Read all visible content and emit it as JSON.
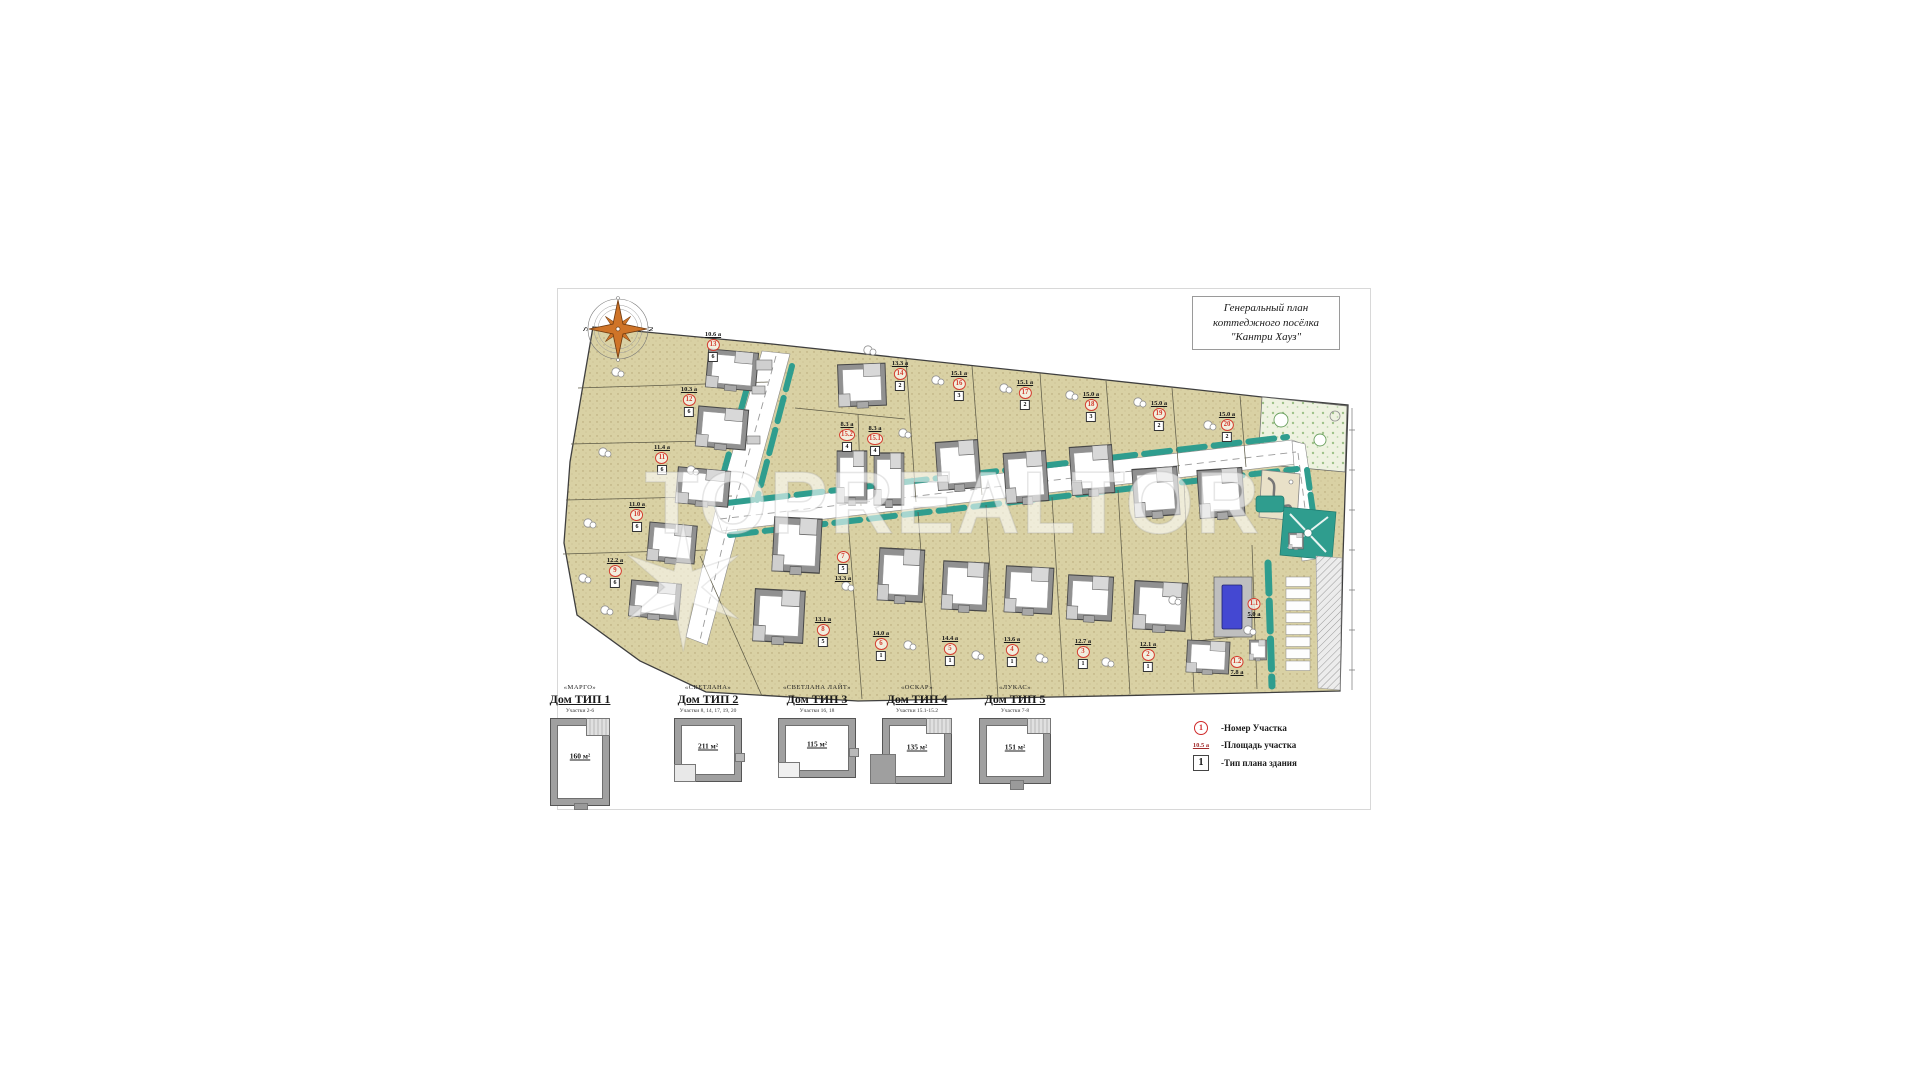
{
  "sheet": {
    "title_lines": [
      "Генеральный план",
      "коттеджного посёлка",
      "\"Кантри Хауз\""
    ],
    "watermark": "TOPREALTOR"
  },
  "compass": {
    "west": "S",
    "east": "N"
  },
  "map": {
    "plots": [
      {
        "n": "13",
        "area": "10.6 а",
        "type": "6",
        "x": 713,
        "y": 331
      },
      {
        "n": "12",
        "area": "10.3 а",
        "type": "6",
        "x": 689,
        "y": 386
      },
      {
        "n": "11",
        "area": "11.4 а",
        "type": "6",
        "x": 662,
        "y": 444
      },
      {
        "n": "10",
        "area": "11.0 а",
        "type": "6",
        "x": 637,
        "y": 501
      },
      {
        "n": "9",
        "area": "12.2 а",
        "type": "6",
        "x": 615,
        "y": 557
      },
      {
        "n": "8",
        "area": "13.1 а",
        "type": "5",
        "x": 823,
        "y": 616
      },
      {
        "n": "7",
        "area": "13.3 а",
        "type": "5",
        "x": 843,
        "y": 551,
        "order": [
          "num",
          "type",
          "area"
        ]
      },
      {
        "n": "14",
        "area": "13.3 а",
        "type": "2",
        "x": 900,
        "y": 360
      },
      {
        "n": "15.2",
        "area": "8.3 а",
        "type": "4",
        "x": 847,
        "y": 421
      },
      {
        "n": "15.1",
        "area": "8.3 а",
        "type": "4",
        "x": 875,
        "y": 425
      },
      {
        "n": "16",
        "area": "15.1 а",
        "type": "3",
        "x": 959,
        "y": 370
      },
      {
        "n": "17",
        "area": "15.1 а",
        "type": "2",
        "x": 1025,
        "y": 379
      },
      {
        "n": "18",
        "area": "15.0 а",
        "type": "3",
        "x": 1091,
        "y": 391
      },
      {
        "n": "19",
        "area": "15.0 а",
        "type": "2",
        "x": 1159,
        "y": 400
      },
      {
        "n": "20",
        "area": "15.0 а",
        "type": "2",
        "x": 1227,
        "y": 411
      },
      {
        "n": "6",
        "area": "14.0 а",
        "type": "1",
        "x": 881,
        "y": 630
      },
      {
        "n": "5",
        "area": "14.4 а",
        "type": "1",
        "x": 950,
        "y": 635
      },
      {
        "n": "4",
        "area": "13.6 а",
        "type": "1",
        "x": 1012,
        "y": 636
      },
      {
        "n": "3",
        "area": "12.7 а",
        "type": "1",
        "x": 1083,
        "y": 638
      },
      {
        "n": "2",
        "area": "12.1 а",
        "type": "1",
        "x": 1148,
        "y": 641
      },
      {
        "n": "1.1",
        "area": "5.0 а",
        "x": 1254,
        "y": 598,
        "order": [
          "num",
          "area"
        ]
      },
      {
        "n": "1.2",
        "area": "7.8 а",
        "x": 1237,
        "y": 656,
        "order": [
          "num",
          "area"
        ]
      }
    ]
  },
  "house_types": [
    {
      "name": "«МАРГО»",
      "title": "Дом ТИП 1",
      "plots_note": "Участки 2-6",
      "area": "160 м²"
    },
    {
      "name": "«СВЕТЛАНА»",
      "title": "Дом ТИП 2",
      "plots_note": "Участки 8, 14, 17, 19, 20",
      "area": "211 м²"
    },
    {
      "name": "«СВЕТЛАНА ЛАЙТ»",
      "title": "Дом ТИП 3",
      "plots_note": "Участки 16, 18",
      "area": "115 м²"
    },
    {
      "name": "«ОСКАР»",
      "title": "Дом ТИП 4",
      "plots_note": "Участки 15.1-15.2",
      "area": "135 м²"
    },
    {
      "name": "«ЛУКАС»",
      "title": "Дом ТИП 5",
      "plots_note": "Участки 7-8",
      "area": "151 м²"
    }
  ],
  "legend": {
    "items": [
      {
        "symbol_text": "1",
        "label": "-Номер Участка"
      },
      {
        "symbol_text": "10.5 а",
        "label": "-Площадь участка"
      },
      {
        "symbol_text": "1",
        "label": "-Тип плана здания"
      }
    ]
  }
}
